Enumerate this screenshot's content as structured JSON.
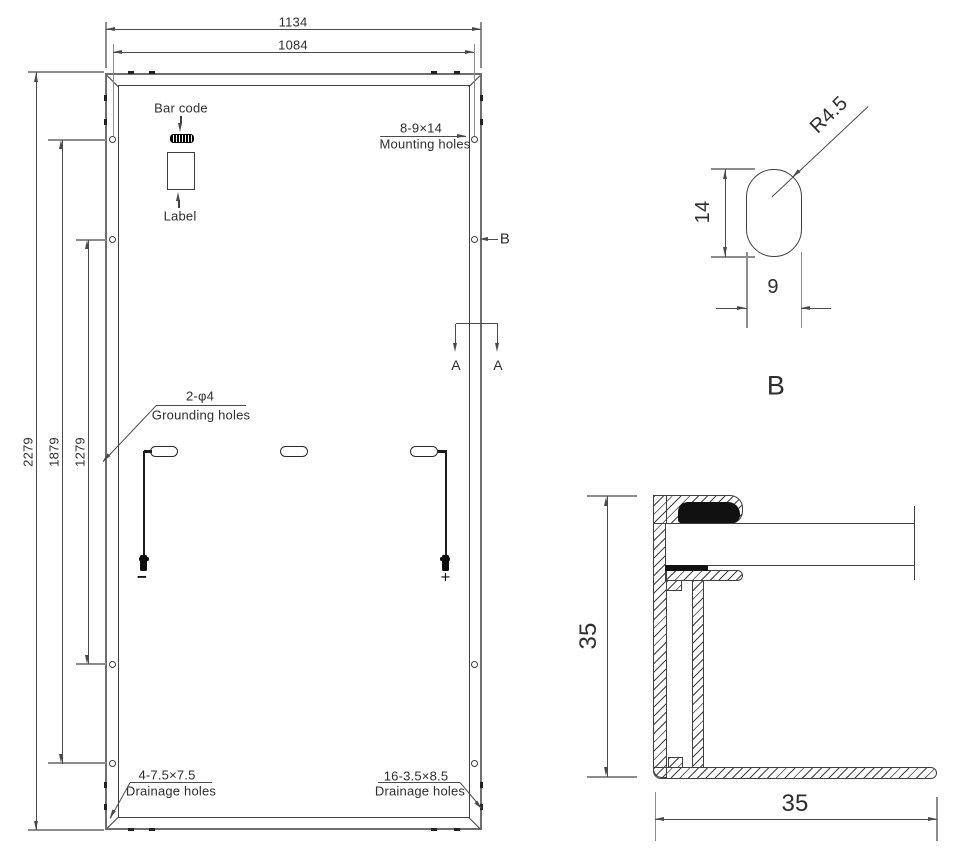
{
  "drawing": {
    "panel": {
      "dim_width_outer": "1134",
      "dim_width_inner": "1084",
      "dim_height_outer": "2279",
      "dim_height_mid": "1879",
      "dim_height_inner": "1279",
      "barcode_label": "Bar code",
      "label_label": "Label",
      "mounting_spec": "8-9×14",
      "mounting_label": "Mounting holes",
      "grounding_spec": "2-φ4",
      "grounding_label": "Grounding holes",
      "drainage_left_spec": "4-7.5×7.5",
      "drainage_left_label": "Drainage holes",
      "drainage_right_spec": "16-3.5×8.5",
      "drainage_right_label": "Drainage holes",
      "section_a": "A",
      "section_b": "B",
      "negative": "−",
      "positive": "+"
    },
    "detail_b": {
      "radius": "R4.5",
      "height": "14",
      "width": "9",
      "title": "B"
    },
    "frame_section": {
      "height": "35",
      "width": "35"
    }
  },
  "colors": {
    "line": "#3f3f3f",
    "dim": "#4a4a4a",
    "ext": "#8c8c8c",
    "frame": "#6f6f6f",
    "text": "#2e2e2e",
    "fill": "#111111",
    "bg": "#ffffff"
  }
}
